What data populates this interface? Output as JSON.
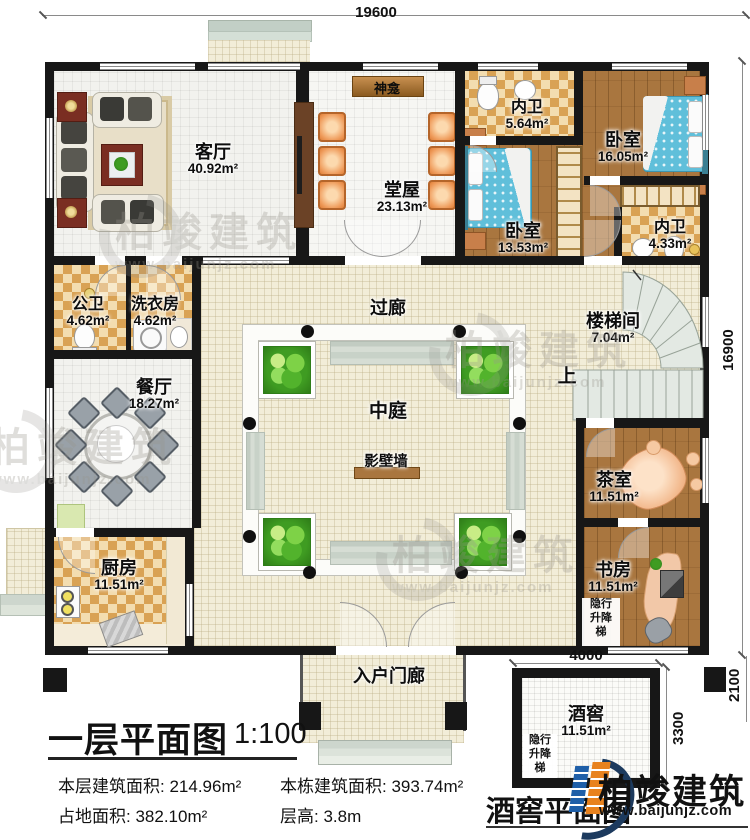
{
  "dims": {
    "top": "19600",
    "right": "16900"
  },
  "rooms": {
    "living": {
      "name": "客厅",
      "area": "40.92m²"
    },
    "shrine": {
      "name": "神龛"
    },
    "hall": {
      "name": "堂屋",
      "area": "23.13m²"
    },
    "bath_top": {
      "name": "内卫",
      "area": "5.64m²"
    },
    "bedroom_right": {
      "name": "卧室",
      "area": "16.05m²"
    },
    "bedroom_left": {
      "name": "卧室",
      "area": "13.53m²"
    },
    "bath_mid": {
      "name": "内卫",
      "area": "4.33m²"
    },
    "public_bath": {
      "name": "公卫",
      "area": "4.62m²"
    },
    "laundry": {
      "name": "洗衣房",
      "area": "4.62m²"
    },
    "corridor": {
      "name": "过廊"
    },
    "stairwell": {
      "name": "楼梯间",
      "area": "7.04m²"
    },
    "up_mark": "上",
    "dining": {
      "name": "餐厅",
      "area": "18.27m²"
    },
    "atrium": {
      "name": "中庭"
    },
    "screen_wall": {
      "name": "影壁墙"
    },
    "tea": {
      "name": "茶室",
      "area": "11.51m²"
    },
    "kitchen": {
      "name": "厨房",
      "area": "11.51m²"
    },
    "study": {
      "name": "书房",
      "area": "11.51m²"
    },
    "porch": {
      "name": "入户门廊"
    },
    "cellar": {
      "name": "酒窖",
      "area": "11.51m²"
    },
    "elevator": {
      "l1": "隐行",
      "l2": "升降",
      "l3": "梯"
    }
  },
  "cellar_dims": {
    "width": "4000",
    "height": "3300",
    "corner": "2100"
  },
  "title_block": {
    "title": "一层平面图",
    "scale": "1:100",
    "floor_area_label": "本层建筑面积:",
    "floor_area": "214.96m²",
    "building_area_label": "本栋建筑面积:",
    "building_area": "393.74m²",
    "land_area_label": "占地面积:",
    "land_area": "382.10m²",
    "height_label": "层高:",
    "height": "3.8m",
    "cellar_plan_title": "酒窖平面图"
  },
  "branding": {
    "brand": "柏竣建筑",
    "url": "www.baijunjz.com"
  },
  "watermark": {
    "brand": "柏竣建筑",
    "url": "www.baijunjz.com"
  },
  "colors": {
    "wall": "#171717",
    "wood": "#a9763f",
    "checker": "#d9a254",
    "bed_blue": "#60bfda",
    "chair_orange": "#ef9c5c",
    "logo_blue": "#1f5fa8",
    "logo_orange": "#e8821e",
    "logo_navy": "#1c3a5e",
    "watermark_gray": "#98948c"
  }
}
